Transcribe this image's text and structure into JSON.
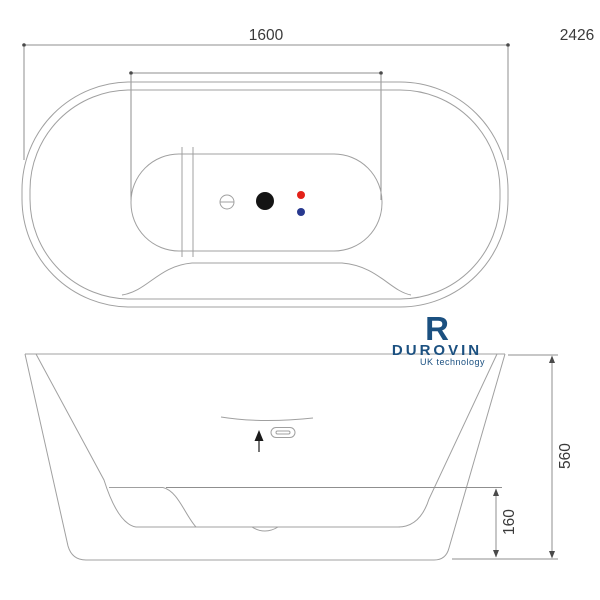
{
  "drawing": {
    "top_length_label": "1600",
    "sheet_number": "2426",
    "side_height_label": "560",
    "side_base_label": "160"
  },
  "logo": {
    "mark": "R",
    "brand": "DUROVIN",
    "tagline": "UK technology"
  },
  "colors": {
    "line": "#a0a0a0",
    "dim_text": "#3a3a3a",
    "logo_navy": "#1b5080",
    "hot_dot": "#e32119",
    "cold_dot": "#28398f",
    "drain": "#141414",
    "background": "#ffffff"
  }
}
